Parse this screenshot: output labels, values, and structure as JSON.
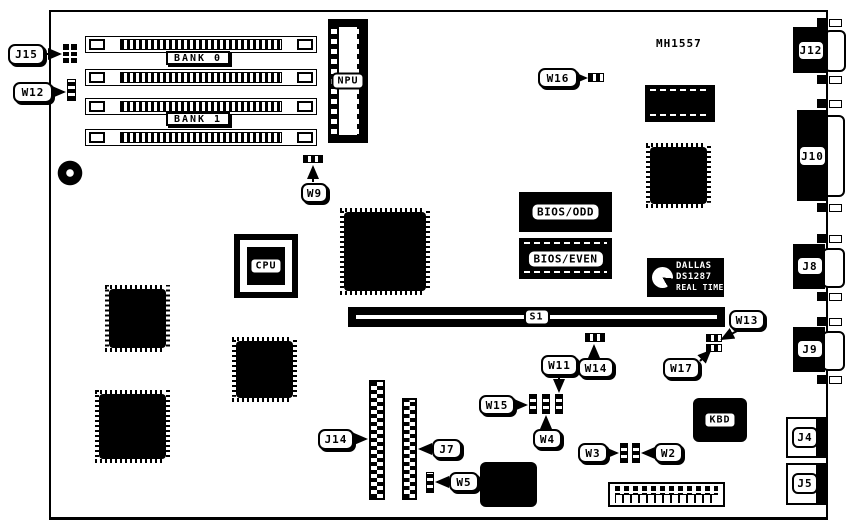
{
  "diagram": {
    "part_number": "MH1557",
    "callouts": {
      "j15": "J15",
      "w12": "W12",
      "w9": "W9",
      "w16": "W16",
      "w13": "W13",
      "w17": "W17",
      "w11": "W11",
      "w14": "W14",
      "w15": "W15",
      "w4": "W4",
      "w3": "W3",
      "w2": "W2",
      "j14": "J14",
      "j7": "J7",
      "w5": "W5"
    },
    "ports": {
      "j12": "J12",
      "j10": "J10",
      "j8": "J8",
      "j9": "J9",
      "j4": "J4",
      "j5": "J5"
    },
    "chips": {
      "bank0": "BANK 0",
      "bank1": "BANK 1",
      "npu": "NPU",
      "cpu": "CPU",
      "bios_odd": "BIOS/ODD",
      "bios_even": "BIOS/EVEN",
      "s1": "S1",
      "kbd": "KBD"
    },
    "rtc": {
      "line1": "DALLAS",
      "line2": "DS1287",
      "line3": "REAL TIME"
    },
    "colors": {
      "ink": "#000000",
      "paper": "#ffffff"
    }
  }
}
